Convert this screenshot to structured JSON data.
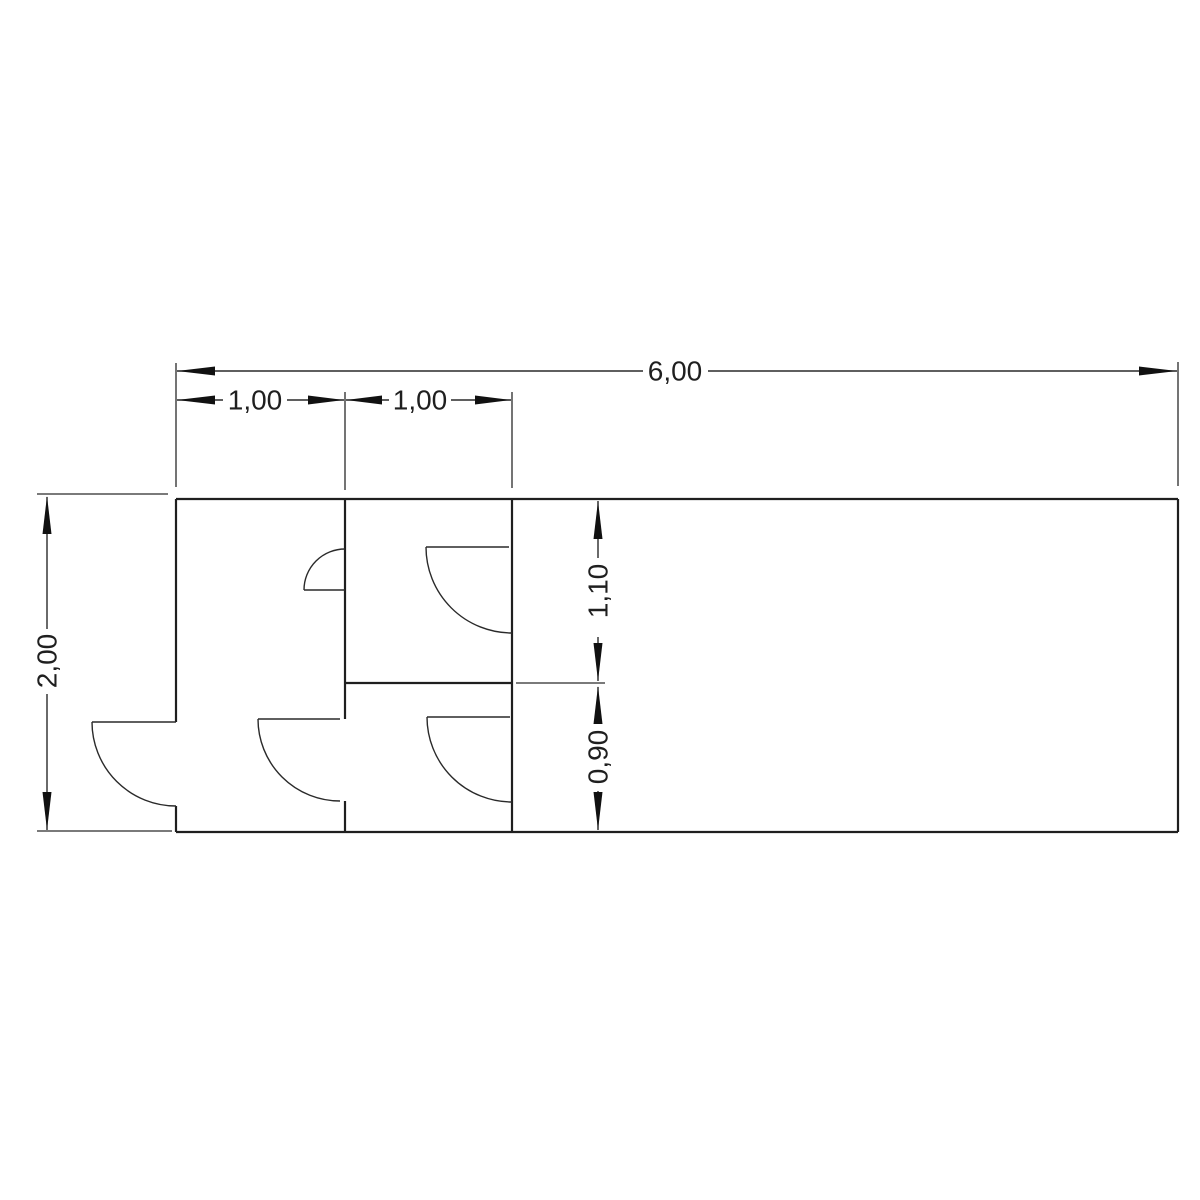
{
  "page": {
    "background_color": "#ffffff",
    "kind": "architectural floor plan, CAD line drawing"
  },
  "drawing": {
    "line_color": "#1f1f1f",
    "dimension_color": "#2a2a2a",
    "overall_width_label": "6,00",
    "overall_height_label": "2,00",
    "dimensions": {
      "total_width": {
        "label": "6,00",
        "orientation": "horizontal",
        "position": "top"
      },
      "room1_width": {
        "label": "1,00",
        "orientation": "horizontal",
        "position": "top"
      },
      "room2_width": {
        "label": "1,00",
        "orientation": "horizontal",
        "position": "top"
      },
      "total_height": {
        "label": "2,00",
        "orientation": "vertical",
        "position": "left"
      },
      "upper_room_height": {
        "label": "1,10",
        "orientation": "vertical",
        "position": "interior"
      },
      "lower_room_height": {
        "label": "0,90",
        "orientation": "vertical",
        "position": "interior"
      }
    },
    "doors": [
      {
        "id": "door-a",
        "hinge_wall": "interior-wall-1",
        "swing": "up-left"
      },
      {
        "id": "door-b",
        "hinge_wall": "outer-left-wall",
        "swing": "down-left, outward"
      },
      {
        "id": "door-c",
        "hinge_wall": "interior-wall-1",
        "swing": "down-left"
      },
      {
        "id": "door-d",
        "hinge_wall": "interior-wall-2",
        "swing": "down-left"
      },
      {
        "id": "door-e",
        "hinge_wall": "interior-wall-2",
        "swing": "down-left"
      }
    ],
    "walls": {
      "outer_rectangle": true,
      "interior_vertical_walls": 2,
      "interior_horizontal_divider": 1
    }
  }
}
